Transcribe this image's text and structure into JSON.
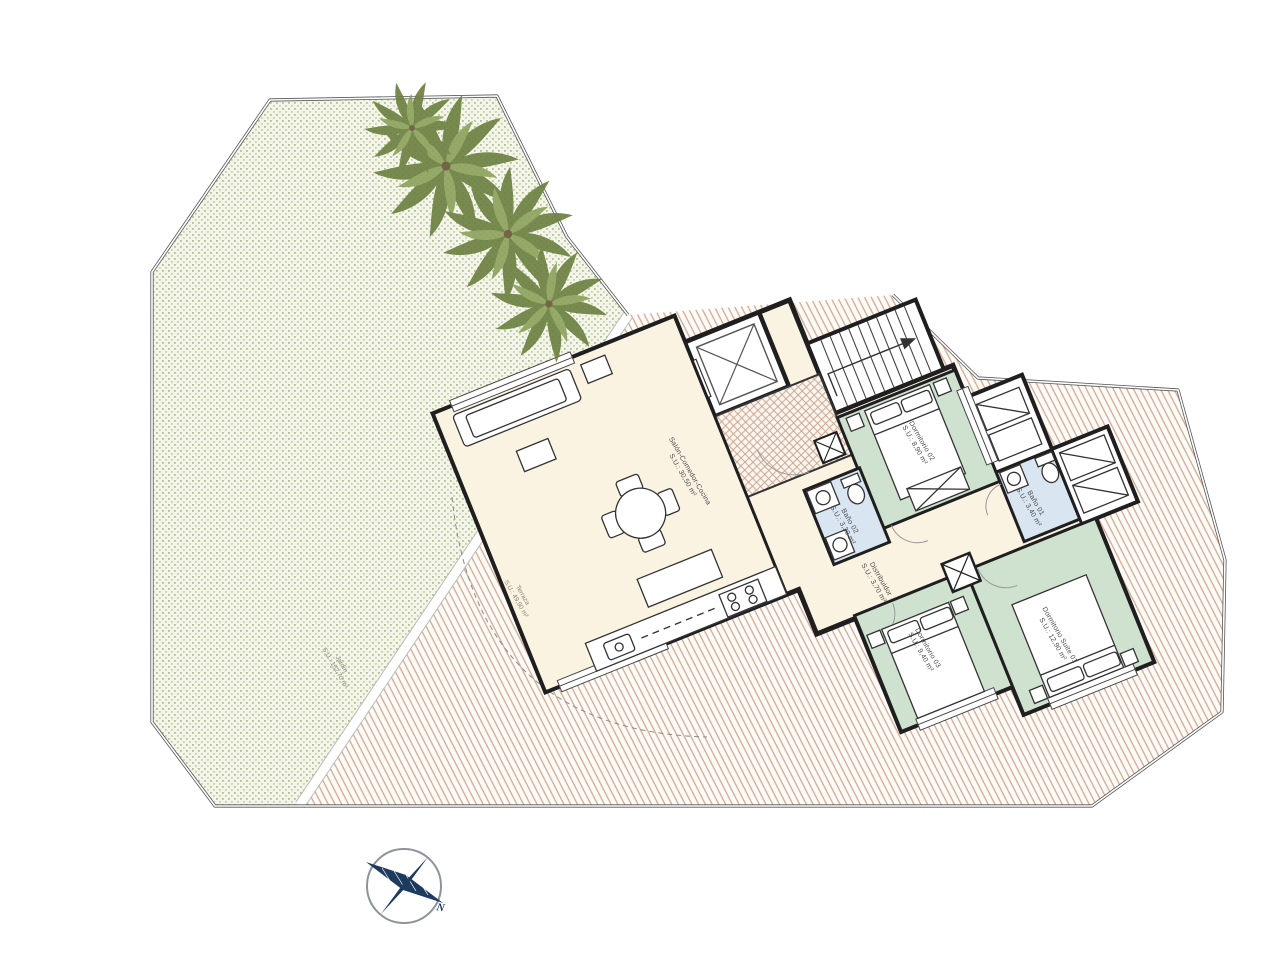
{
  "plan": {
    "type": "apartment-floor-plan",
    "rooms": [
      {
        "id": "living",
        "name": "Salón-Comedor-Cocina",
        "area": "S.U.: 30,50 m²"
      },
      {
        "id": "dormitorio02",
        "name": "Dormitorio 02",
        "area": "S.U.: 8,90 m²"
      },
      {
        "id": "bano02",
        "name": "Baño 02",
        "area": "S.U.: 3,30 m²"
      },
      {
        "id": "distribuidor",
        "name": "Distribuidor",
        "area": "S.U.: 3,70 m²"
      },
      {
        "id": "bano01",
        "name": "Baño 01",
        "area": "S.U.: 3,40 m²"
      },
      {
        "id": "dormitorio03",
        "name": "Dormitorio 03",
        "area": "S.U.: 9,40 m²"
      },
      {
        "id": "suite01",
        "name": "Dormitorio Suite 01",
        "area": "S.U.: 12,90 m²"
      }
    ],
    "outdoor": {
      "terraza": {
        "name": "Terraza",
        "area": "S.U.: 49,90 m²"
      },
      "jardin": {
        "name": "Jardín",
        "area": "S.U.: 152,70 m²"
      }
    },
    "compass": {
      "north_label": "N"
    }
  },
  "colors": {
    "living_fill": "#fbf3e2",
    "bedroom_fill": "#cfe2d0",
    "bath_fill": "#d9e5f1",
    "wall": "#1f1f1f",
    "terrace_hatch": "#d2ab92",
    "garden_dot": "#b3bf8c",
    "compass_navy": "#1d3a5f",
    "boundary": "#555555"
  }
}
